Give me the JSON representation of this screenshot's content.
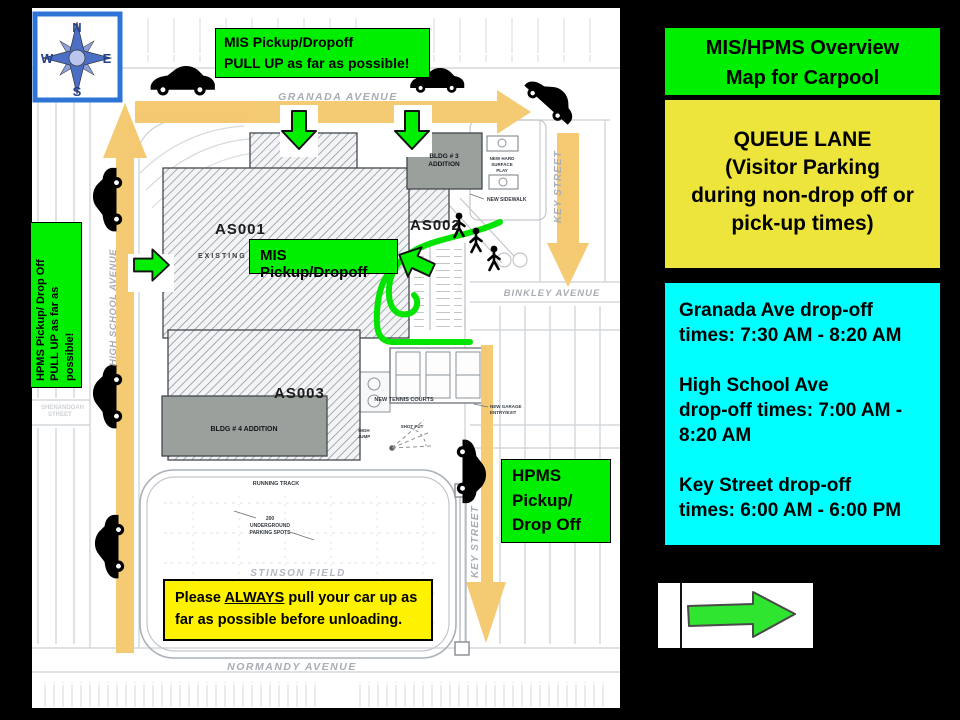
{
  "colors": {
    "green": "#00EF00",
    "yellow_queue": "#EDE53C",
    "yellow_notice": "#FFF200",
    "cyan": "#00FFFF",
    "arrow_tan": "#F4C86E"
  },
  "compass": {
    "n": "N",
    "e": "E",
    "s": "S",
    "w": "W"
  },
  "map": {
    "streets": {
      "granada": "GRANADA AVENUE",
      "high_school": "HIGH SCHOOL AVENUE",
      "key": "KEY STREET",
      "binkley": "BINKLEY AVENUE",
      "normandy": "NORMANDY AVENUE",
      "shenandoah": [
        "SHENANDOAH",
        "STREET"
      ]
    },
    "buildings": {
      "as001": "AS001",
      "as002": "AS002",
      "as003": "AS003",
      "bldg3": [
        "BLDG # 3",
        "ADDITION"
      ],
      "bldg4": "BLDG # 4 ADDITION",
      "existing": "EXISTING"
    },
    "features": {
      "hard_surface": [
        "NEW HARD",
        "SURFACE",
        "PLAY"
      ],
      "new_sidewalk": "NEW SIDEWALK",
      "garage": [
        "NEW GARAGE",
        "ENTRY/EXIT"
      ],
      "tennis": "NEW TENNIS COURTS",
      "running_track": "RUNNING TRACK",
      "high_jump": [
        "HIGH",
        "JUMP"
      ],
      "shot_put": "SHOT PUT",
      "underground": [
        "200",
        "UNDERGROUND",
        "PARKING SPOTS"
      ],
      "stinson": "STINSON FIELD"
    },
    "callouts": {
      "mis_top": "MIS Pickup/Dropoff\nPULL UP as far as possible!",
      "mis_mid": "MIS Pickup/Dropoff",
      "hpms_side": "HPMS Pickup/ Drop Off\nPULL UP as far as\npossible!",
      "hpms_right": "HPMS\nPickup/\nDrop Off",
      "notice_prefix": "Please ",
      "notice_underline": "ALWAYS",
      "notice_suffix": " pull your car up as far as possible before unloading."
    }
  },
  "panel": {
    "title": "MIS/HPMS Overview\nMap for Carpool",
    "queue_lane": "QUEUE LANE\n(Visitor Parking\nduring non-drop off or\npick-up times)",
    "times": {
      "granada": "Granada Ave drop-off\ntimes: 7:30 AM - 8:20 AM",
      "high_school": "High School Ave\ndrop-off times: 7:00 AM -\n8:20 AM",
      "key": "Key Street drop-off\ntimes: 6:00 AM - 6:00 PM"
    }
  }
}
